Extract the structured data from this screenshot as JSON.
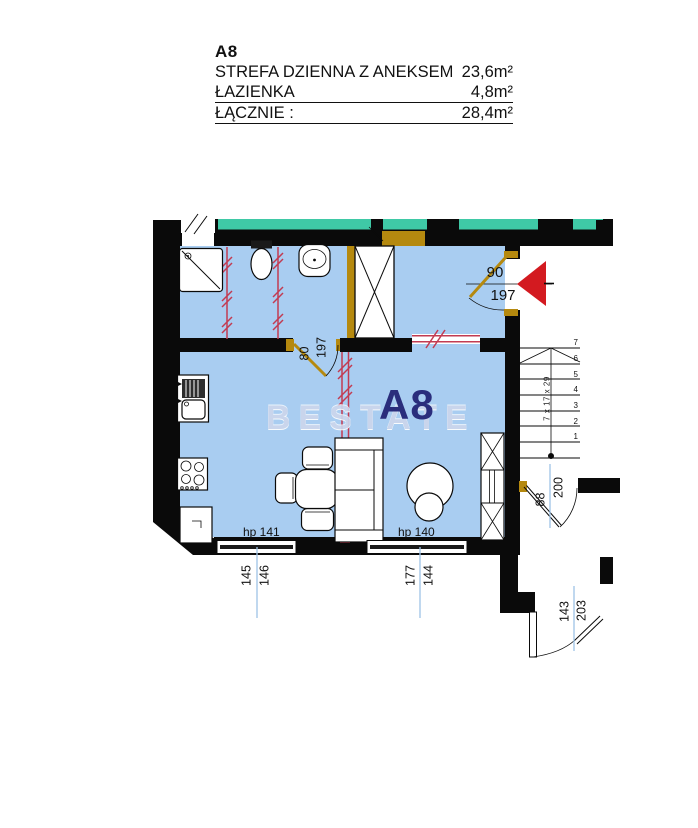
{
  "legend": {
    "unit_code": "A8",
    "rows": [
      {
        "label": "STREFA DZIENNA Z ANEKSEM",
        "value": "23,6m²"
      },
      {
        "label": "ŁAZIENKA",
        "value": "4,8m²"
      },
      {
        "label": "ŁĄCZNIE :",
        "value": "28,4m²"
      }
    ]
  },
  "plan": {
    "room_label": "A8",
    "watermark": "BESTATE",
    "windows": [
      {
        "name": "hp 141",
        "dim_a": "145",
        "dim_b": "146"
      },
      {
        "name": "hp 140",
        "dim_a": "177",
        "dim_b": "144"
      }
    ],
    "doors": {
      "entrance": {
        "width": "90",
        "height": "197"
      },
      "bathroom": {
        "width": "80",
        "height": "197"
      },
      "staircase": {
        "width": "88",
        "height": "200"
      },
      "balcony": {
        "width": "143",
        "height": "203"
      }
    },
    "stairs": {
      "steps": [
        "1",
        "2",
        "3",
        "4",
        "5",
        "6",
        "7"
      ],
      "note": "7 x 17 x 29"
    },
    "colors": {
      "floor": "#a9cdf1",
      "wall": "#0a0a0a",
      "teal_band": "#3fc9a6",
      "gold": "#b5890f",
      "red_mark": "#c23b52",
      "arrow_red": "#d31a20",
      "room_label": "#2a2d7c",
      "leader": "#9fc4e6",
      "watermark": "#ccd6ec"
    }
  }
}
